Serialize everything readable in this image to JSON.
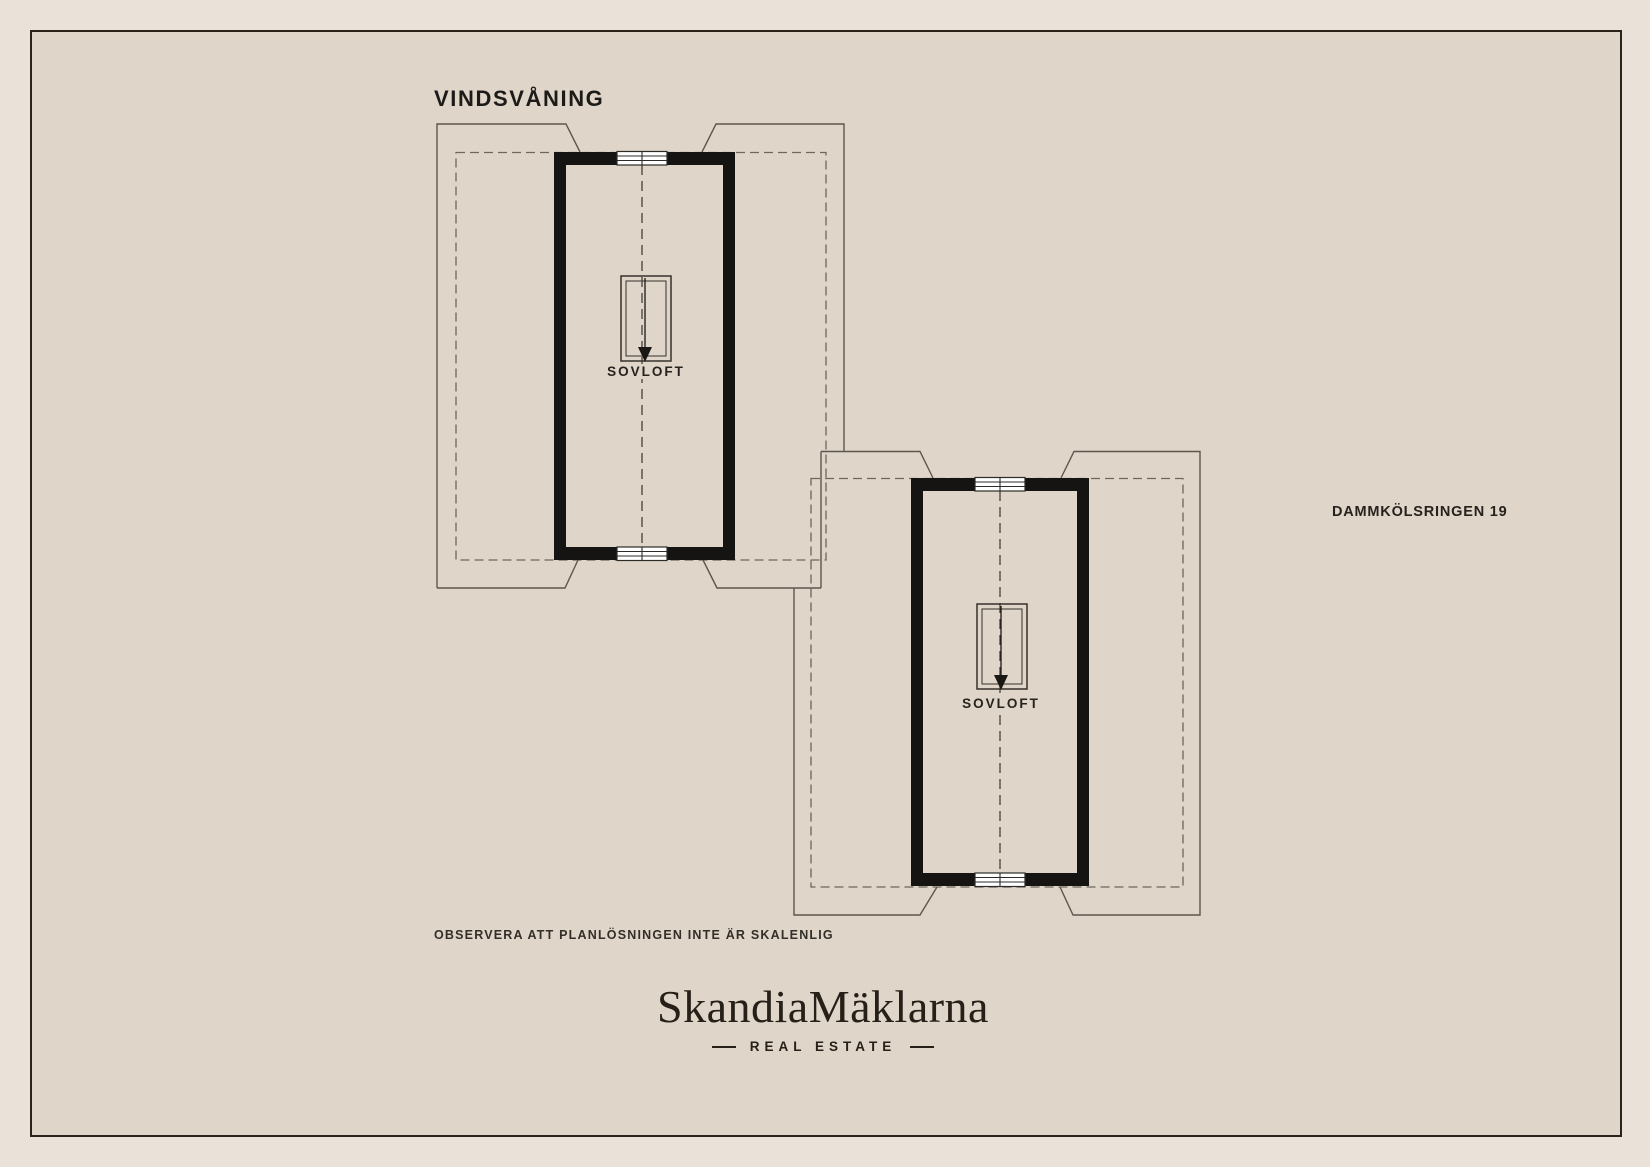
{
  "page": {
    "title": "VINDSVÅNING",
    "address": "DAMMKÖLSRINGEN 19",
    "disclaimer": "OBSERVERA ATT PLANLÖSNINGEN INTE ÄR SKALENLIG"
  },
  "plans": [
    {
      "id": "attic-section-upper-left",
      "room_label": "SOVLOFT"
    },
    {
      "id": "attic-section-lower-right",
      "room_label": "SOVLOFT"
    }
  ],
  "logo": {
    "brand": "SkandiaMäklarna",
    "tagline": "REAL ESTATE"
  },
  "icons": {
    "loft_hatch": "double-rectangle-ladder-opening",
    "arrow_down": "▼",
    "window": "four-pane-window-symbol"
  },
  "colors": {
    "canvas": "#eae2d8",
    "paper": "#dfd5c9",
    "frame_border": "#2b231b",
    "wall": "#161412",
    "roof_outline": "#5e574e",
    "dashed_boundary": "#6f675d",
    "center_line": "#46413a",
    "text": "#1d1b18"
  }
}
